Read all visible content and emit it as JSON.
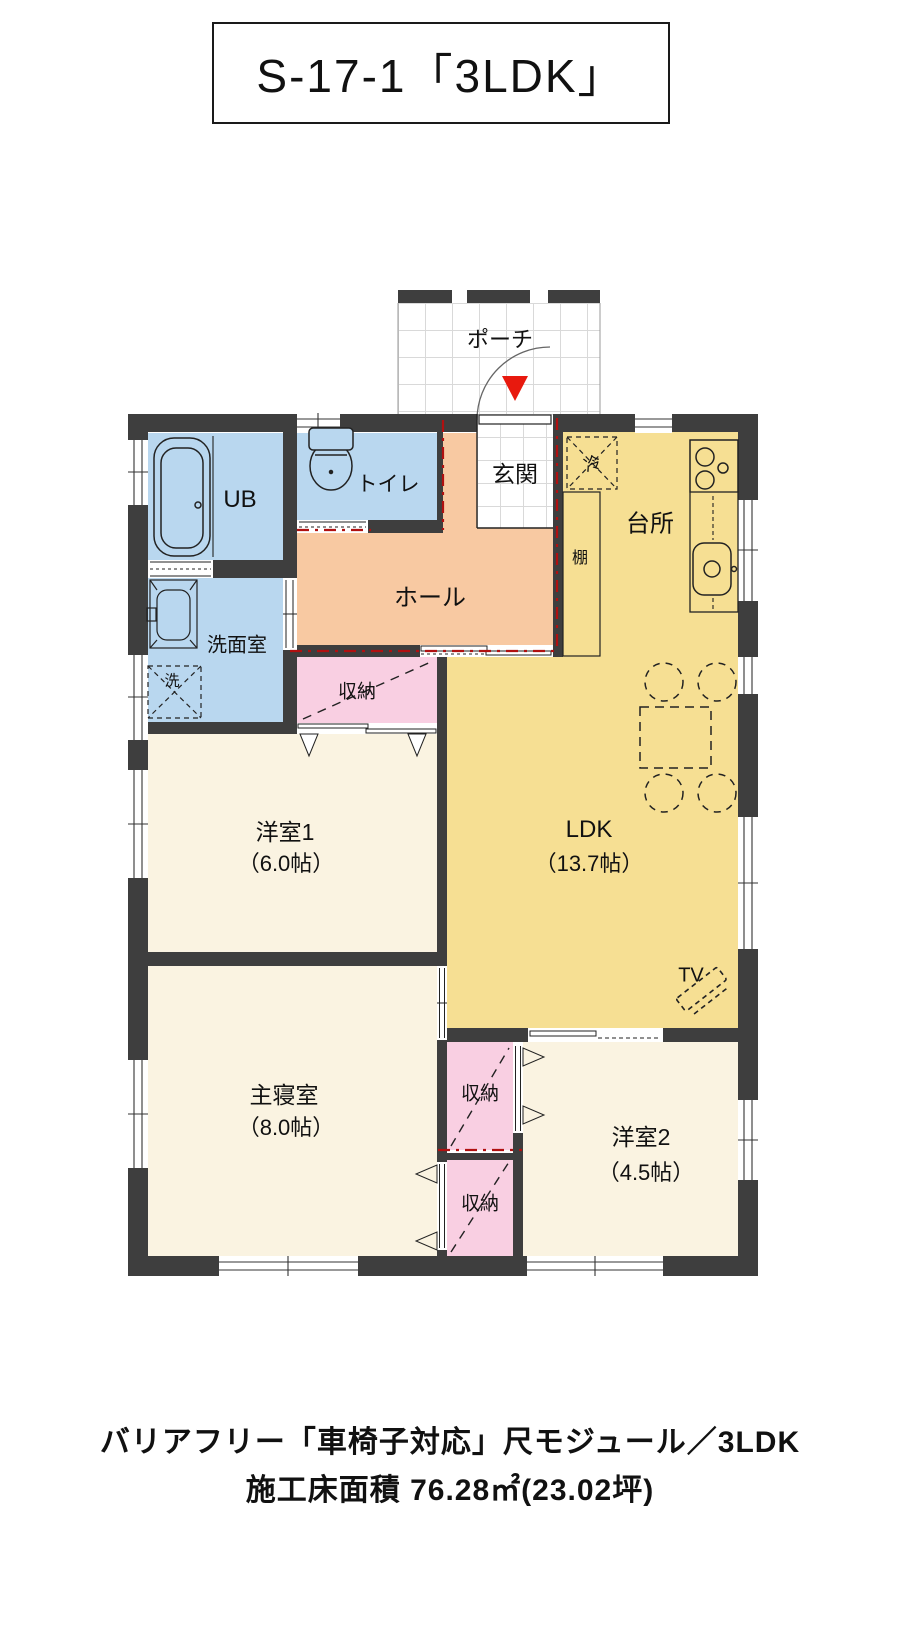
{
  "title": "S-17-1「3LDK」",
  "caption": {
    "line1": "バリアフリー「車椅子対応」尺モジュール／3LDK",
    "line2": "施工床面積 76.28㎡(23.02坪)"
  },
  "rooms": {
    "porch": {
      "label": "ポーチ"
    },
    "entrance": {
      "label": "玄関"
    },
    "ub": {
      "label": "UB"
    },
    "toilet": {
      "label": "トイレ"
    },
    "washroom": {
      "label": "洗面室"
    },
    "washer": {
      "label": "洗"
    },
    "hall": {
      "label": "ホール"
    },
    "kitchen": {
      "label": "台所"
    },
    "fridge": {
      "label": "冷"
    },
    "shelf": {
      "label": "棚"
    },
    "ldk": {
      "label": "LDK",
      "size": "（13.7帖）"
    },
    "closet1": {
      "label": "収納"
    },
    "closet2": {
      "label": "収納"
    },
    "closet3": {
      "label": "収納"
    },
    "bedroom1": {
      "label": "洋室1",
      "size": "（6.0帖）"
    },
    "master": {
      "label": "主寝室",
      "size": "（8.0帖）"
    },
    "bedroom2": {
      "label": "洋室2",
      "size": "（4.5帖）"
    },
    "tv": {
      "label": "TV"
    }
  },
  "colors": {
    "wall": "#3e3e3e",
    "wet_area_blue": "#b9d7ef",
    "hall_orange": "#f8c9a2",
    "ldk_yellow": "#f6df93",
    "closet_pink": "#f9cfe2",
    "room_cream": "#faf3e1",
    "entry_marker_red": "#e8190e",
    "module_line_red": "#b01010"
  }
}
